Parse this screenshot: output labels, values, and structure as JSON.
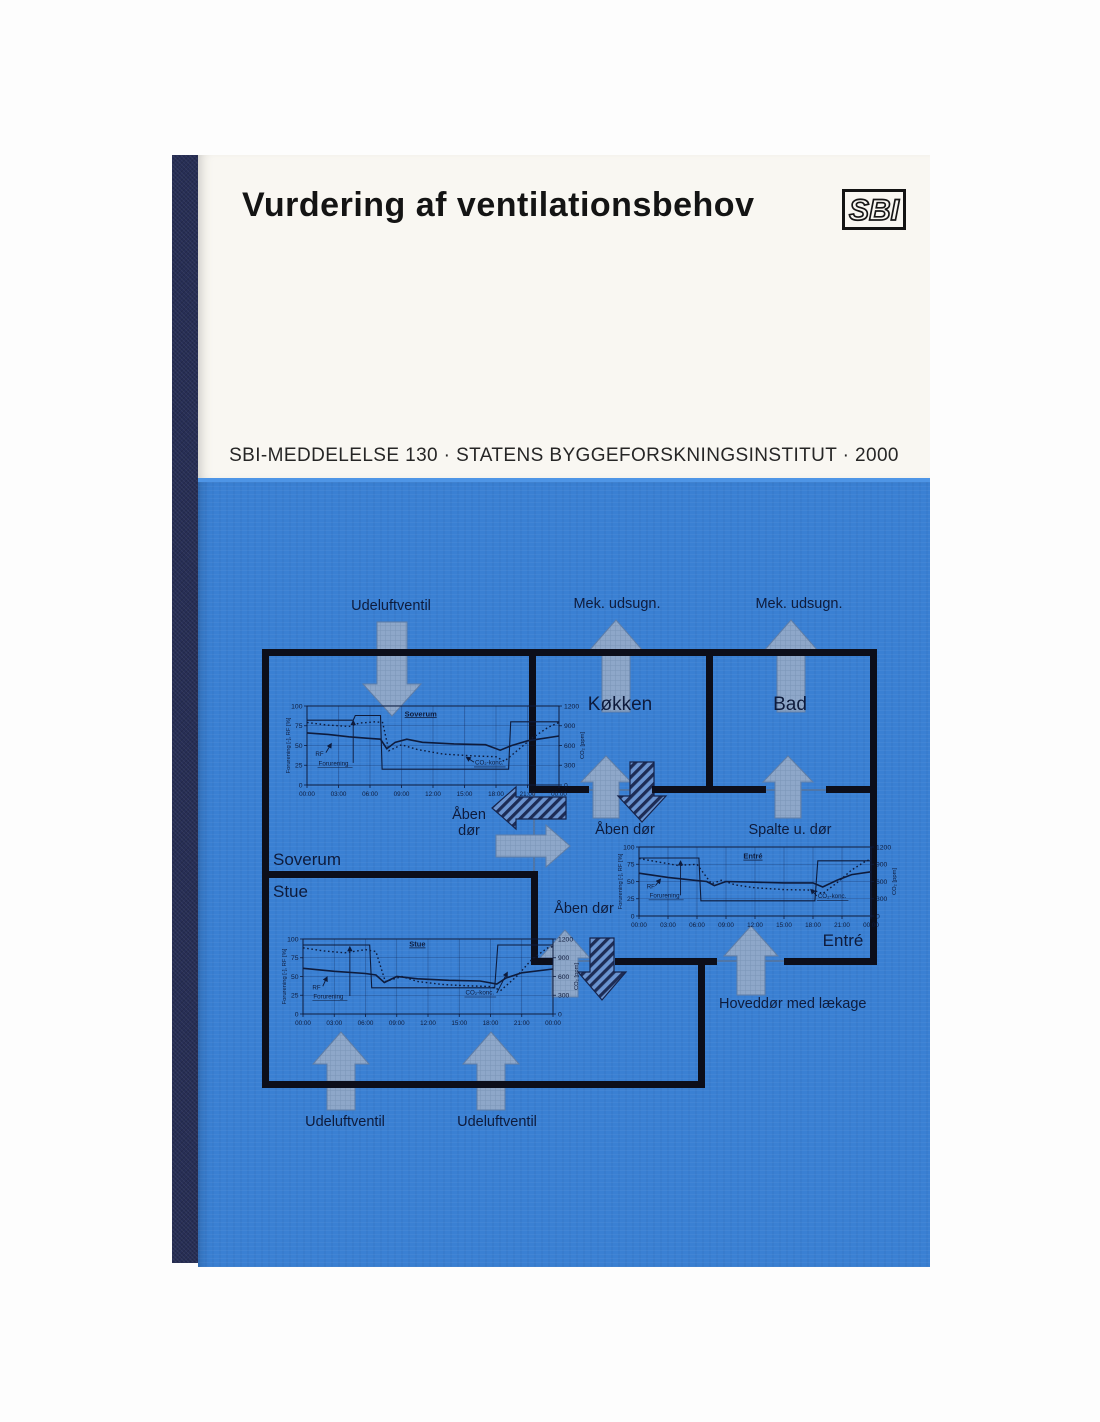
{
  "book": {
    "title": "Vurdering af ventilationsbehov",
    "logo_text": "SBI",
    "imprint": "SBI-MEDDELELSE 130 · STATENS BYGGEFORSKNINGSINSTITUT · 2000",
    "colors": {
      "cover_blue": "#3a80d3",
      "spine_navy": "#272e55",
      "cover_white": "#f9f7f2",
      "wall_black": "#0c0e1a",
      "diagram_text": "#0e1b3c",
      "arrow_fill": "#8ea7c9"
    }
  },
  "diagram": {
    "labels": {
      "udeluftventil_top": "Udeluftventil",
      "mek_udsugn_koekken": "Mek. udsugn.",
      "mek_udsugn_bad": "Mek. udsugn.",
      "room_koekken": "Køkken",
      "room_bad": "Bad",
      "aaben_doer_soverum": "Åben dør",
      "aaben_doer_koekken": "Åben dør",
      "spalte_u_doer": "Spalte u. dør",
      "room_soverum": "Soverum",
      "room_stue": "Stue",
      "aaben_doer_stue": "Åben dør",
      "room_entre": "Entré",
      "hoveddoer": "Hoveddør med lækage",
      "udeluftventil_bottom_1": "Udeluftventil",
      "udeluftventil_bottom_2": "Udeluftventil"
    }
  },
  "chart_data": [
    {
      "type": "line",
      "title": "Soverum",
      "xlabel_ticks": [
        "00:00",
        "03:00",
        "06:00",
        "09:00",
        "12:00",
        "15:00",
        "18:00",
        "21:00",
        "00:00"
      ],
      "x_hours_range": [
        0,
        24
      ],
      "left_axis": {
        "label": "Forurening [-], RF [%]",
        "ticks": [
          0,
          25,
          50,
          75,
          100
        ],
        "range": [
          0,
          100
        ]
      },
      "right_axis": {
        "label": "CO₂ [ppm]",
        "ticks": [
          0,
          300,
          600,
          900,
          1200
        ],
        "range": [
          0,
          1200
        ]
      },
      "title_pos": [
        9.3,
        87
      ],
      "series": [
        {
          "name": "Forurening",
          "axis": "left",
          "style": "solid",
          "points": [
            [
              0,
              82
            ],
            [
              4.4,
              82
            ],
            [
              4.6,
              88
            ],
            [
              7.0,
              88
            ],
            [
              7.15,
              20
            ],
            [
              19.2,
              20
            ],
            [
              19.4,
              80
            ],
            [
              24,
              80
            ]
          ]
        },
        {
          "name": "RF",
          "axis": "left",
          "style": "solid",
          "points": [
            [
              0,
              66
            ],
            [
              2,
              64
            ],
            [
              4,
              61
            ],
            [
              6,
              59
            ],
            [
              7,
              58
            ],
            [
              7.6,
              46
            ],
            [
              8.4,
              54
            ],
            [
              9.5,
              58
            ],
            [
              11,
              54
            ],
            [
              14,
              52
            ],
            [
              17,
              51
            ],
            [
              18.4,
              44
            ],
            [
              19.5,
              50
            ],
            [
              21,
              56
            ],
            [
              24,
              62
            ]
          ]
        },
        {
          "name": "CO₂-konc.",
          "axis": "right",
          "style": "dotted",
          "points": [
            [
              0,
              950
            ],
            [
              2,
              910
            ],
            [
              4,
              890
            ],
            [
              5,
              940
            ],
            [
              6.5,
              960
            ],
            [
              7.2,
              950
            ],
            [
              7.8,
              520
            ],
            [
              9,
              610
            ],
            [
              10.5,
              540
            ],
            [
              13,
              470
            ],
            [
              16,
              440
            ],
            [
              18,
              430
            ],
            [
              18.8,
              360
            ],
            [
              20,
              520
            ],
            [
              21.5,
              720
            ],
            [
              23,
              880
            ],
            [
              24,
              950
            ]
          ]
        }
      ],
      "annotations": [
        {
          "text": "RF",
          "x": 0.8,
          "y": 37,
          "sx": 1.8,
          "sy": 41,
          "ex": 2.3,
          "ey": 52,
          "boxed": false
        },
        {
          "text": "Forurening",
          "x": 1.1,
          "y": 25,
          "sx": 4.4,
          "sy": 28,
          "ex": 4.4,
          "ey": 81,
          "boxed": true
        },
        {
          "text": "CO₂-konc.",
          "x": 16.0,
          "y": 26,
          "sx": 15.9,
          "sy": 29,
          "ex": 15.2,
          "ey": 35,
          "boxed": true
        }
      ]
    },
    {
      "type": "line",
      "title": "Stue",
      "xlabel_ticks": [
        "00:00",
        "03:00",
        "06:00",
        "09:00",
        "12:00",
        "15:00",
        "18:00",
        "21:00",
        "00:00"
      ],
      "x_hours_range": [
        0,
        24
      ],
      "left_axis": {
        "label": "Forurening [-], RF [%]",
        "ticks": [
          0,
          25,
          50,
          75,
          100
        ],
        "range": [
          0,
          100
        ]
      },
      "right_axis": {
        "label": "CO₂ [ppm]",
        "ticks": [
          0,
          300,
          600,
          900,
          1200
        ],
        "range": [
          0,
          1200
        ]
      },
      "title_pos": [
        10.2,
        90
      ],
      "series": [
        {
          "name": "Forurening",
          "axis": "left",
          "style": "solid",
          "points": [
            [
              0,
              92
            ],
            [
              6.4,
              92
            ],
            [
              6.6,
              35
            ],
            [
              18.4,
              35
            ],
            [
              18.7,
              92
            ],
            [
              24,
              92
            ]
          ]
        },
        {
          "name": "RF",
          "axis": "left",
          "style": "solid",
          "points": [
            [
              0,
              61
            ],
            [
              3,
              57
            ],
            [
              6,
              54
            ],
            [
              7,
              52
            ],
            [
              7.8,
              42
            ],
            [
              9,
              50
            ],
            [
              11,
              47
            ],
            [
              14,
              45
            ],
            [
              17,
              44
            ],
            [
              18.6,
              40
            ],
            [
              19.5,
              48
            ],
            [
              21,
              55
            ],
            [
              24,
              60
            ]
          ]
        },
        {
          "name": "CO₂-konc.",
          "axis": "right",
          "style": "dotted",
          "points": [
            [
              0,
              1060
            ],
            [
              2,
              1010
            ],
            [
              4,
              980
            ],
            [
              6,
              1030
            ],
            [
              7,
              1000
            ],
            [
              7.9,
              520
            ],
            [
              9.5,
              600
            ],
            [
              11,
              520
            ],
            [
              13.5,
              470
            ],
            [
              16,
              450
            ],
            [
              18,
              440
            ],
            [
              19,
              380
            ],
            [
              20.5,
              600
            ],
            [
              22,
              880
            ],
            [
              23.5,
              1060
            ],
            [
              24,
              1080
            ]
          ]
        }
      ],
      "annotations": [
        {
          "text": "RF",
          "x": 0.9,
          "y": 33,
          "sx": 1.9,
          "sy": 37,
          "ex": 2.3,
          "ey": 49,
          "boxed": false
        },
        {
          "text": "Forurening",
          "x": 1.0,
          "y": 21,
          "sx": 4.5,
          "sy": 24,
          "ex": 4.5,
          "ey": 89,
          "boxed": true
        },
        {
          "text": "CO₂-konc.",
          "x": 15.6,
          "y": 26,
          "sx": 18.6,
          "sy": 28,
          "ex": 19.6,
          "ey": 55,
          "boxed": true
        }
      ]
    },
    {
      "type": "line",
      "title": "Entré",
      "xlabel_ticks": [
        "00:00",
        "03:00",
        "06:00",
        "09:00",
        "12:00",
        "15:00",
        "18:00",
        "21:00",
        "00:00"
      ],
      "x_hours_range": [
        0,
        24
      ],
      "left_axis": {
        "label": "Forurening [-], RF [%]",
        "ticks": [
          0,
          25,
          50,
          75,
          100
        ],
        "range": [
          0,
          100
        ]
      },
      "right_axis": {
        "label": "CO₂ [ppm]",
        "ticks": [
          0,
          300,
          600,
          900,
          1200
        ],
        "range": [
          0,
          1200
        ]
      },
      "title_pos": [
        10.8,
        83
      ],
      "series": [
        {
          "name": "Forurening",
          "axis": "left",
          "style": "solid",
          "points": [
            [
              0,
              84
            ],
            [
              6.2,
              84
            ],
            [
              6.4,
              22
            ],
            [
              18.2,
              22
            ],
            [
              18.5,
              80
            ],
            [
              24,
              80
            ]
          ]
        },
        {
          "name": "RF",
          "axis": "left",
          "style": "solid",
          "points": [
            [
              0,
              62
            ],
            [
              3,
              56
            ],
            [
              5.5,
              52
            ],
            [
              7,
              50
            ],
            [
              7.8,
              44
            ],
            [
              9,
              50
            ],
            [
              12,
              49
            ],
            [
              15,
              48
            ],
            [
              18,
              48
            ],
            [
              19,
              42
            ],
            [
              20.5,
              52
            ],
            [
              22,
              60
            ],
            [
              24,
              64
            ]
          ]
        },
        {
          "name": "CO₂-konc.",
          "axis": "right",
          "style": "dotted",
          "points": [
            [
              0,
              1000
            ],
            [
              2,
              940
            ],
            [
              4,
              880
            ],
            [
              6,
              900
            ],
            [
              7.5,
              560
            ],
            [
              8.5,
              620
            ],
            [
              10,
              540
            ],
            [
              12,
              490
            ],
            [
              15,
              460
            ],
            [
              18,
              450
            ],
            [
              19,
              390
            ],
            [
              20.5,
              580
            ],
            [
              22,
              800
            ],
            [
              23.5,
              960
            ],
            [
              24,
              980
            ]
          ]
        }
      ],
      "annotations": [
        {
          "text": "RF",
          "x": 0.8,
          "y": 40,
          "sx": 1.7,
          "sy": 44,
          "ex": 2.2,
          "ey": 53,
          "boxed": false
        },
        {
          "text": "Forurening",
          "x": 1.1,
          "y": 27,
          "sx": 4.3,
          "sy": 30,
          "ex": 4.3,
          "ey": 79,
          "boxed": true
        },
        {
          "text": "CO₂-konc.",
          "x": 18.5,
          "y": 26,
          "sx": 18.4,
          "sy": 29,
          "ex": 17.8,
          "ey": 38,
          "boxed": true
        }
      ]
    }
  ]
}
